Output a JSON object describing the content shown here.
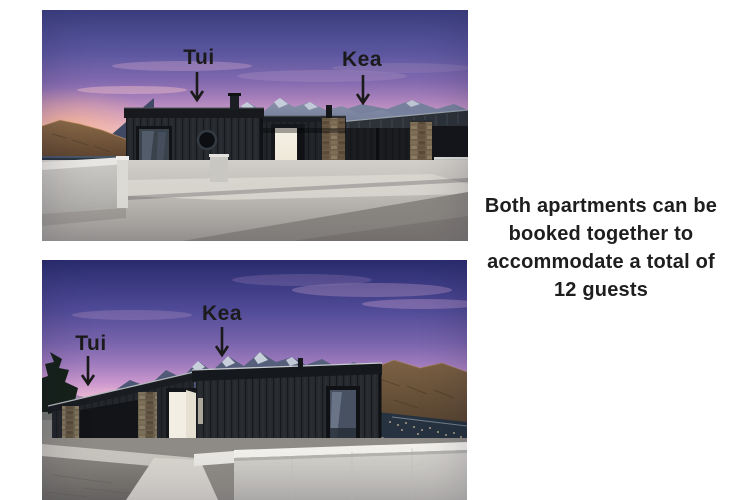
{
  "page": {
    "background_color": "#ffffff"
  },
  "caption": {
    "lines": [
      "Both apartments can be",
      "booked together to",
      "accommodate a total of",
      "12 guests"
    ],
    "text_color": "#1e1e1e"
  },
  "photos": {
    "top": {
      "alt": "Dusk view of the black timber apartments from the street with mountains behind",
      "labels": {
        "tui": {
          "text": "Tui"
        },
        "kea": {
          "text": "Kea"
        }
      }
    },
    "bottom": {
      "alt": "Dusk view of the apartments from the driveway with mountain range and lake behind",
      "labels": {
        "tui": {
          "text": "Tui"
        },
        "kea": {
          "text": "Kea"
        }
      }
    }
  },
  "icons": {
    "down_arrow": "↓"
  },
  "palette": {
    "label_text": "#1b1b1b",
    "sky_top_blue": "#3e4286",
    "sky_pink": "#e6b3c6",
    "building_charcoal": "#26292e",
    "stone_brown": "#6e5e49",
    "concrete_light": "#d9d6cf",
    "lake_dark": "#26323f"
  }
}
